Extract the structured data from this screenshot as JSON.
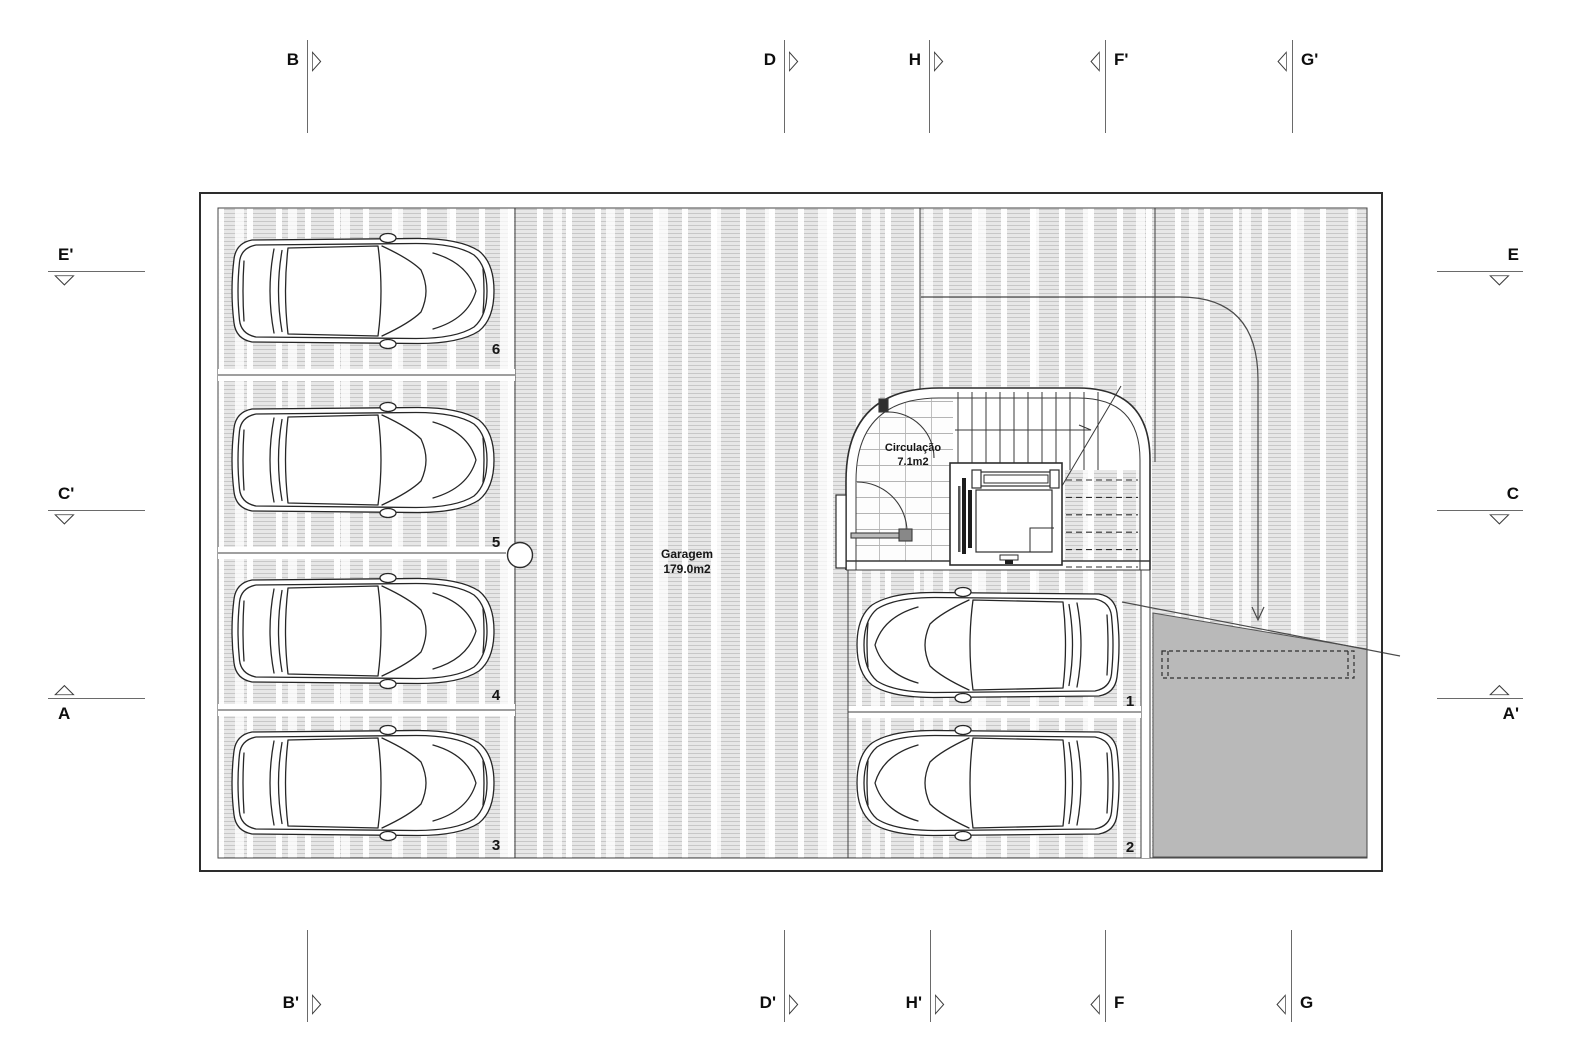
{
  "drawing": {
    "rooms": {
      "garagem": {
        "name": "Garagem",
        "area": "179.0m2"
      },
      "circulacao": {
        "name": "Circulação",
        "area": "7.1m2"
      }
    },
    "stalls": [
      {
        "number": "6"
      },
      {
        "number": "5"
      },
      {
        "number": "4"
      },
      {
        "number": "3"
      },
      {
        "number": "1"
      },
      {
        "number": "2"
      }
    ]
  },
  "section_markers": [
    {
      "id": "B",
      "label": "B",
      "icon": "triangle-right-icon"
    },
    {
      "id": "D",
      "label": "D",
      "icon": "triangle-right-icon"
    },
    {
      "id": "H",
      "label": "H",
      "icon": "triangle-right-icon"
    },
    {
      "id": "F-prime",
      "label": "F'",
      "icon": "triangle-left-icon"
    },
    {
      "id": "G-prime",
      "label": "G'",
      "icon": "triangle-left-icon"
    },
    {
      "id": "B-prime",
      "label": "B'",
      "icon": "triangle-right-icon"
    },
    {
      "id": "D-prime",
      "label": "D'",
      "icon": "triangle-right-icon"
    },
    {
      "id": "H-prime",
      "label": "H'",
      "icon": "triangle-right-icon"
    },
    {
      "id": "F",
      "label": "F",
      "icon": "triangle-left-icon"
    },
    {
      "id": "G",
      "label": "G",
      "icon": "triangle-left-icon"
    },
    {
      "id": "E-prime",
      "label": "E'",
      "icon": "triangle-down-icon"
    },
    {
      "id": "C-prime",
      "label": "C'",
      "icon": "triangle-down-icon"
    },
    {
      "id": "A",
      "label": "A",
      "icon": "triangle-up-icon"
    },
    {
      "id": "E",
      "label": "E",
      "icon": "triangle-down-icon"
    },
    {
      "id": "C",
      "label": "C",
      "icon": "triangle-down-icon"
    },
    {
      "id": "A-prime",
      "label": "A'",
      "icon": "triangle-up-icon"
    }
  ],
  "colors": {
    "line": "#3a3a3a",
    "floor_fill": "#e7e7e7",
    "ramp_fill": "#b9b9b9",
    "wall_fill": "#ffffff"
  }
}
